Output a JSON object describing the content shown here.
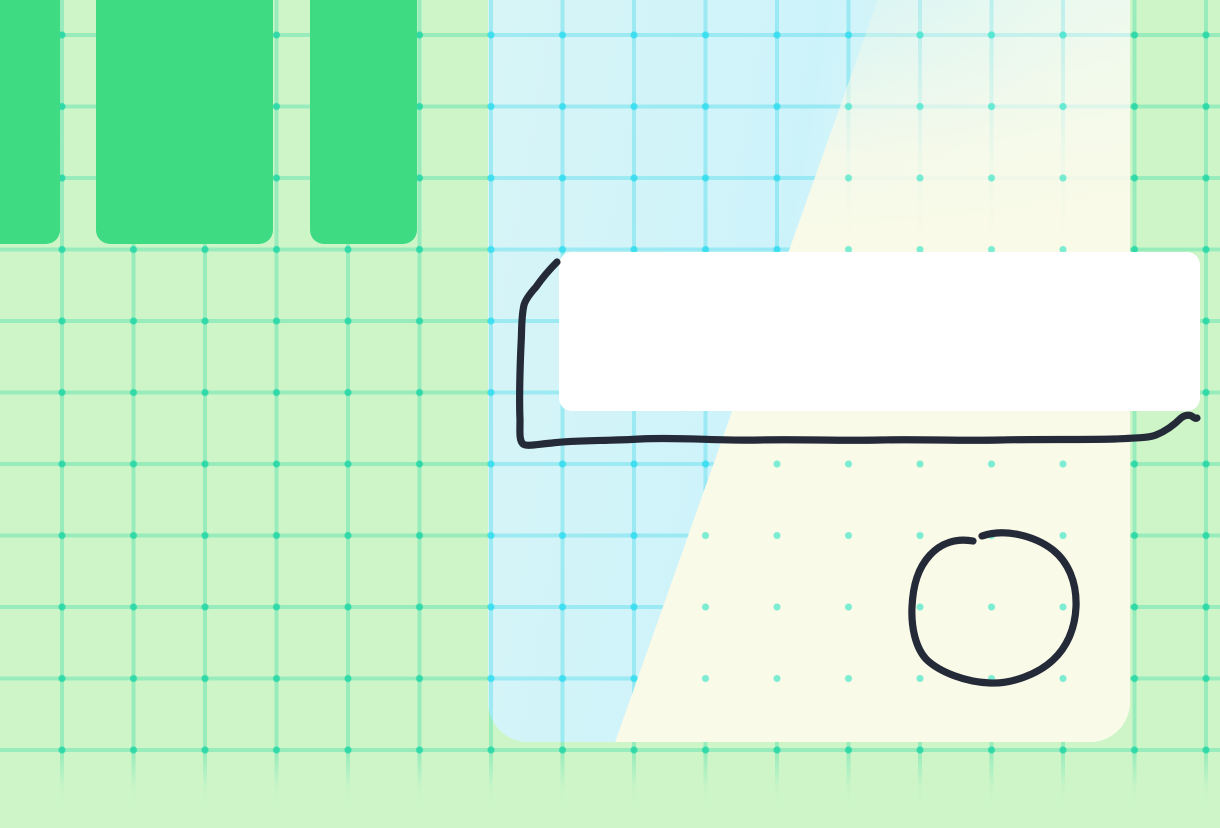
{
  "app": {
    "description": "whiteboard canvas with grid, shapes and pen strokes",
    "visible_text": []
  },
  "colors": {
    "canvas-bg": "#cdf5c8",
    "grid-line": "rgba(74,222,170,0.40)",
    "grid-dot": "rgba(35,215,165,0.85)",
    "shape-green": "#3edb82",
    "panel-cyan": "#cdf3fa",
    "panel-mint": "#effbee",
    "panel-grid-line": "rgba(56,214,232,0.35)",
    "panel-grid-dot": "rgba(56,222,240,0.9)",
    "panel-cream": "#fafae8",
    "cream-dot": "rgba(70,230,200,0.7)",
    "card-white": "#ffffff",
    "ink": "#252a38"
  },
  "grid": {
    "cell_size_px": 71.5,
    "vertical_line_start_x": 62,
    "horizontal_line_start_y": 35,
    "line_thickness_px": 4,
    "has_intersection_dots": true,
    "fades_at_bottom": true
  },
  "shapes": {
    "green_cards": [
      {
        "x": -28,
        "y": -24,
        "w": 88,
        "h": 268
      },
      {
        "x": 96,
        "y": -24,
        "w": 177,
        "h": 268
      },
      {
        "x": 310,
        "y": -24,
        "w": 107,
        "h": 268
      }
    ],
    "frame_panel": {
      "x": 488,
      "y": -60,
      "w": 642,
      "h": 802,
      "regions": [
        "cyan-grid-left",
        "cream-right"
      ]
    },
    "white_note_card": {
      "x": 559,
      "y": 252,
      "w": 641,
      "h": 159
    }
  },
  "ink": {
    "rect_outline_path": "M 557 262 Q 545 274 536 287 Q 526 298 524 305 C 521 318 522 330 521 345 C 520 368 519 396 520 420 C 520 432 519 440 523 444 C 527 447 538 444 552 443 C 575 440 605 441 640 439 C 680 437 720 441 760 440 C 800 439 840 441 880 440 C 920 439 960 441 1000 440 C 1040 439 1080 440 1115 439 C 1135 438 1148 438 1156 435 C 1166 431 1174 425 1181 418 C 1186 414 1191 415 1193 417 Q 1196 419 1197 418",
    "circle_scribble_path": "M 982 536 C 1005 528 1035 536 1053 550 C 1068 562 1077 582 1076 607 C 1075 630 1066 648 1053 660 C 1038 674 1012 684 990 683 C 965 682 940 672 927 660 C 916 649 911 628 912 607 C 913 585 918 568 930 555 C 941 543 956 538 973 541"
  }
}
